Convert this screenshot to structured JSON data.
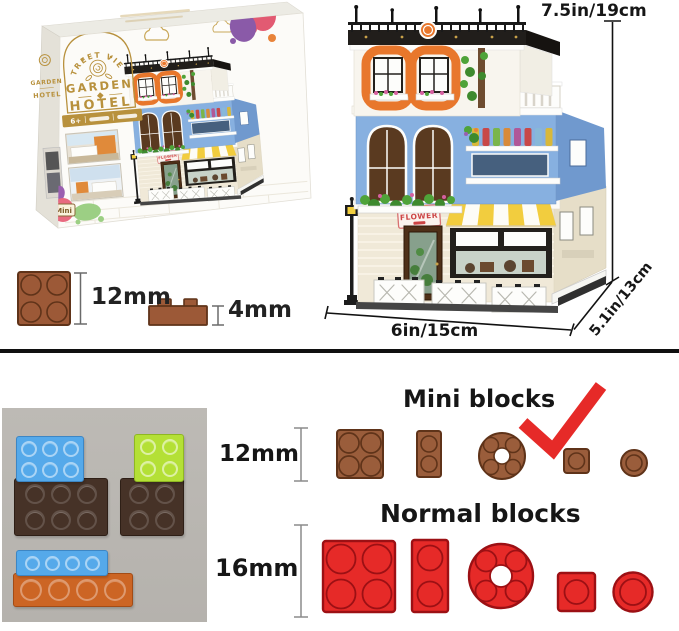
{
  "product_box": {
    "top_arch_text": "STREET VIEW",
    "brand_line1": "GARDEN",
    "brand_line2": "HOTEL",
    "age_banner": "6+",
    "mini_badge": "Mini",
    "side_panel": {
      "brand_line1": "GARDEN",
      "brand_line2": "HOTEL"
    }
  },
  "building_model": {
    "shop_sign": "FLOWER"
  },
  "dimension_labels": {
    "height": "7.5in/19cm",
    "width": "6in/15cm",
    "depth": "5.1in/13cm"
  },
  "brick_scale": {
    "stud": "12mm",
    "plate": "4mm"
  },
  "block_comparison": {
    "mini": {
      "title": "Mini blocks",
      "size": "12mm"
    },
    "normal": {
      "title": "Normal blocks",
      "size": "16mm"
    }
  },
  "colors": {
    "gold": "#b8913d",
    "mini_brown": "#9a5d3b",
    "mini_brown_outline": "#5f3319",
    "normal_red": "#e62a28",
    "normal_red_outline": "#9c1014",
    "checkmark_red": "#e62a28",
    "photo_background": "#b9b6b1",
    "building_blue": "#87b0e0",
    "building_orange": "#e8772c"
  }
}
